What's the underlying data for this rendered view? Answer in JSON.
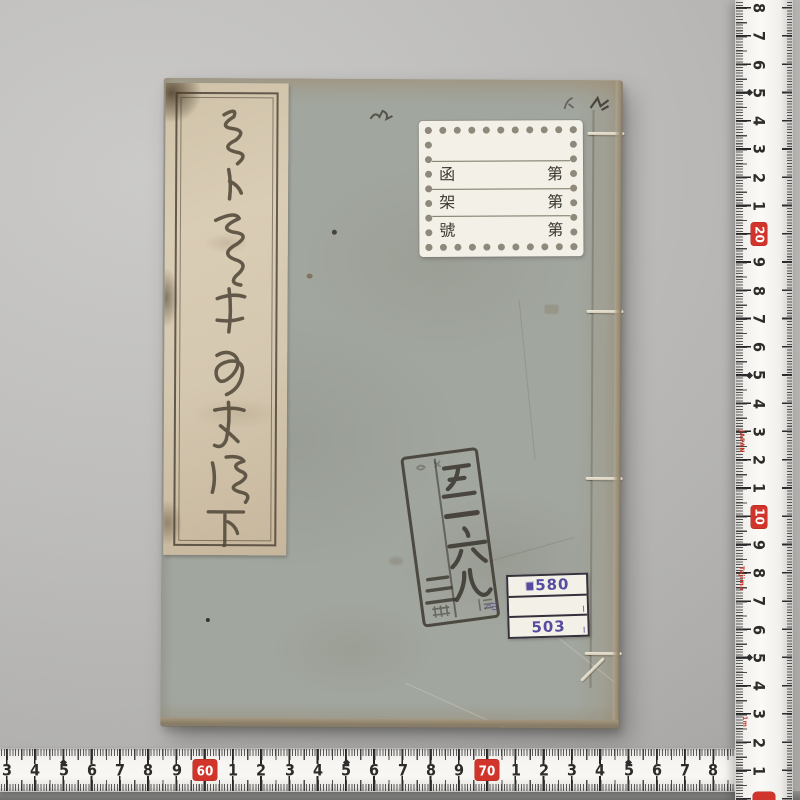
{
  "book": {
    "title_slip": {
      "calligraphy_transcription": "賣卜先生□□傳□（草書・判読困難）",
      "volume_marker": "下"
    },
    "library_label": {
      "rows": [
        {
          "left": "函",
          "right": "第"
        },
        {
          "left": "架",
          "right": "第"
        },
        {
          "left": "號",
          "right": "第"
        }
      ]
    },
    "accession_stamp": {
      "call_number": "五一六九",
      "volume_note": "三冊",
      "small_note": "贈"
    },
    "shelf_label": {
      "top": "580",
      "bottom": "503"
    }
  },
  "rulers": {
    "right": {
      "marks": [
        {
          "t": "8"
        },
        {
          "t": "7"
        },
        {
          "t": "6"
        },
        {
          "t": "5"
        },
        {
          "t": "4"
        },
        {
          "t": "3"
        },
        {
          "t": "2"
        },
        {
          "t": "1"
        },
        {
          "t": "20",
          "red": true
        },
        {
          "t": "9"
        },
        {
          "t": "8"
        },
        {
          "t": "7"
        },
        {
          "t": "6"
        },
        {
          "t": "5"
        },
        {
          "t": "4"
        },
        {
          "t": "3"
        },
        {
          "t": "2"
        },
        {
          "t": "1"
        },
        {
          "t": "10",
          "red": true
        },
        {
          "t": "9"
        },
        {
          "t": "8"
        },
        {
          "t": "7"
        },
        {
          "t": "6"
        },
        {
          "t": "5"
        },
        {
          "t": "4"
        },
        {
          "t": "3"
        },
        {
          "t": "2"
        },
        {
          "t": "1"
        }
      ],
      "side_texts": [
        "JAPAN",
        "Tajima",
        "1m"
      ]
    },
    "bottom": {
      "marks": [
        {
          "t": "3"
        },
        {
          "t": "4"
        },
        {
          "t": "5"
        },
        {
          "t": "6"
        },
        {
          "t": "7"
        },
        {
          "t": "8"
        },
        {
          "t": "9"
        },
        {
          "t": "60",
          "red": true
        },
        {
          "t": "1"
        },
        {
          "t": "2"
        },
        {
          "t": "3"
        },
        {
          "t": "4"
        },
        {
          "t": "5"
        },
        {
          "t": "6"
        },
        {
          "t": "7"
        },
        {
          "t": "8"
        },
        {
          "t": "9"
        },
        {
          "t": "70",
          "red": true
        },
        {
          "t": "1"
        },
        {
          "t": "2"
        },
        {
          "t": "3"
        },
        {
          "t": "4"
        },
        {
          "t": "5"
        },
        {
          "t": "6"
        },
        {
          "t": "7"
        },
        {
          "t": "8"
        }
      ]
    }
  },
  "colors": {
    "ruler_red": "#d0342a",
    "shelf_label_purple": "#564ba0",
    "cover_gray_green": "#a1a69f",
    "stamp_ink": "#3a362e",
    "slip_cream": "#d5c8b0"
  }
}
